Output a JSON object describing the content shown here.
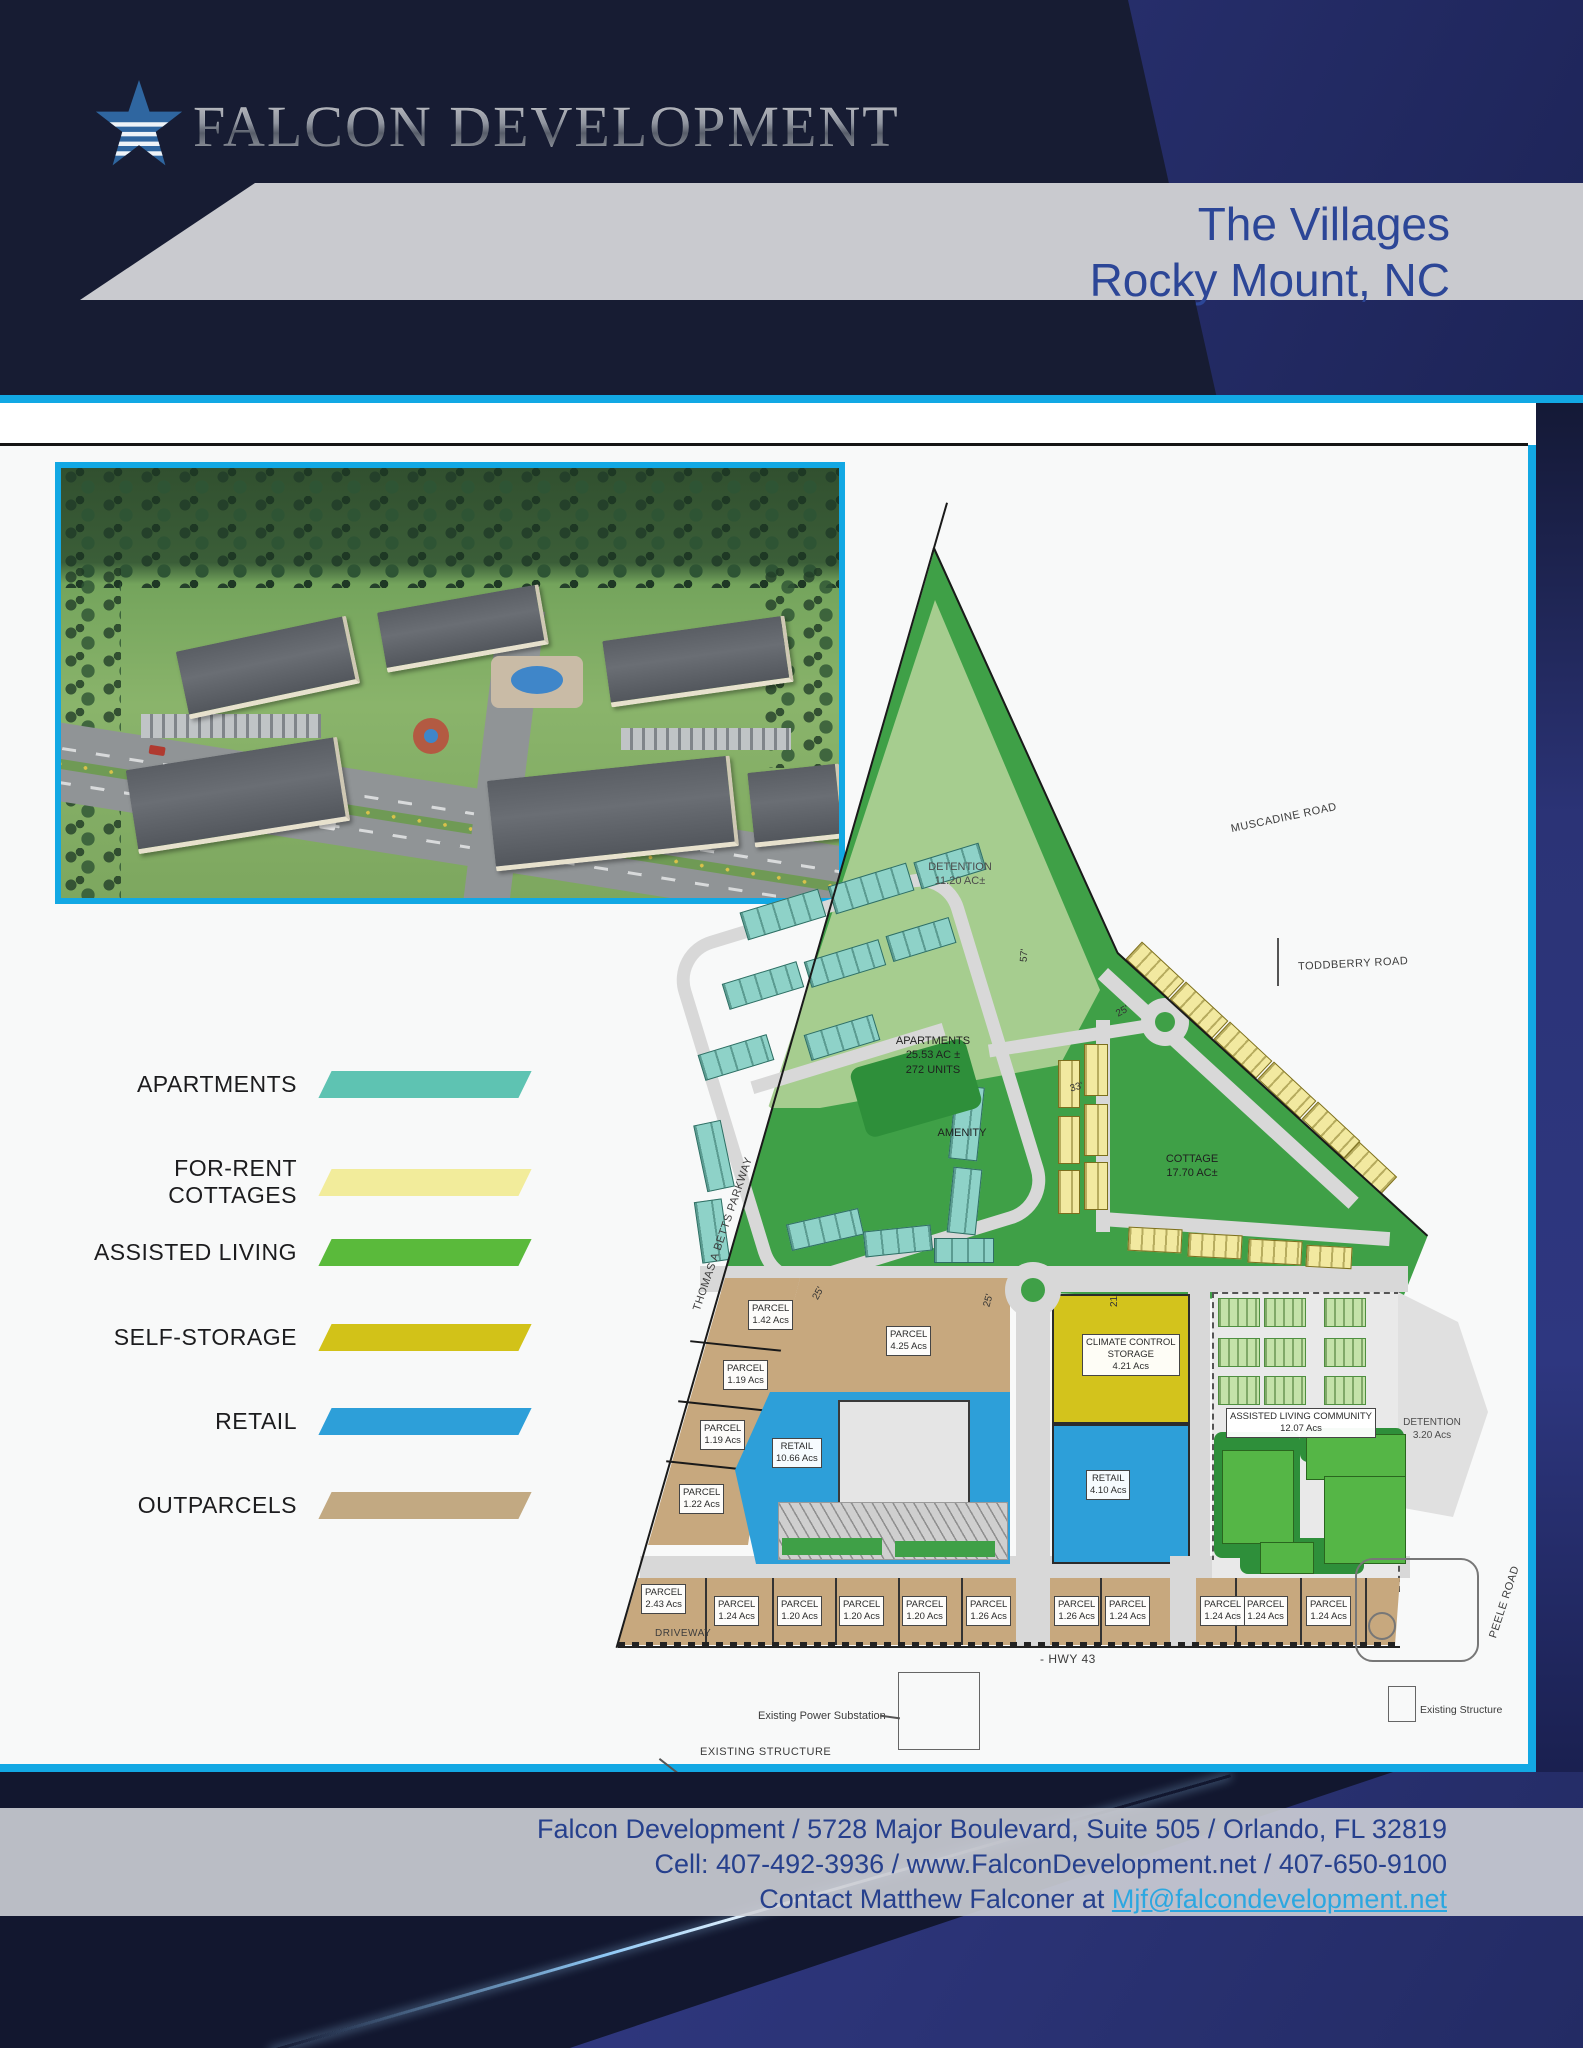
{
  "header": {
    "brand": "FALCON DEVELOPMENT",
    "title_line1": "The Villages",
    "title_line2": "Rocky Mount, NC"
  },
  "legend": {
    "items": [
      {
        "label": "APARTMENTS",
        "color": "#5ec3b2"
      },
      {
        "label": "FOR-RENT COTTAGES",
        "color": "#f2ec9b"
      },
      {
        "label": "ASSISTED LIVING",
        "color": "#5aba3b"
      },
      {
        "label": "SELF-STORAGE",
        "color": "#d2c218"
      },
      {
        "label": "RETAIL",
        "color": "#2d9fd9"
      },
      {
        "label": "OUTPARCELS",
        "color": "#c2a982"
      }
    ]
  },
  "plan": {
    "parcel_word": "PARCEL",
    "west_parcels": [
      "1.42 Acs",
      "1.19 Acs",
      "1.19 Acs",
      "1.22 Acs"
    ],
    "south_parcels": [
      "2.43 Acs",
      "1.24 Acs",
      "1.20 Acs",
      "1.20 Acs",
      "1.20 Acs",
      "1.26 Acs",
      "1.26 Acs",
      "1.24 Acs",
      "1.24 Acs",
      "1.24 Acs",
      "1.24 Acs"
    ],
    "areas": {
      "detention_top": [
        "DETENTION",
        "11.20 AC±"
      ],
      "apartments": [
        "APARTMENTS",
        "25.53 AC ±",
        "272 UNITS"
      ],
      "amenity": "AMENITY",
      "cottage": [
        "COTTAGE",
        "17.70 AC±"
      ],
      "parcel_center": [
        "PARCEL",
        "4.25 Acs"
      ],
      "retail_main": [
        "RETAIL",
        "10.66 Acs"
      ],
      "storage": [
        "CLIMATE CONTROL",
        "STORAGE",
        "4.21 Acs"
      ],
      "retail_east": [
        "RETAIL",
        "4.10 Acs"
      ],
      "assisted_living": [
        "ASSISTED LIVING COMMUNITY",
        "12.07 Acs"
      ],
      "detention_east": [
        "DETENTION",
        "3.20 Acs"
      ]
    },
    "roads": {
      "muscadine": "MUSCADINE ROAD",
      "toddberry": "TODDBERRY ROAD",
      "thomas_betts": "THOMAS A BETTS PARKWAY",
      "peele": "PEELE ROAD",
      "driveway": "DRIVEWAY",
      "hwy43": "- HWY 43"
    },
    "annotations": {
      "power_substation": "Existing Power Substation",
      "existing_structure_sw": "EXISTING STRUCTURE",
      "existing_structure_se": "Existing Structure"
    },
    "dimensions": {
      "a": "25'",
      "b": "25'",
      "c": "33'",
      "d": "57'",
      "e": "21'",
      "f": "25'"
    }
  },
  "colors": {
    "accent_cyan": "#12a8e4",
    "navy": "#171c33",
    "royal_blue": "#2e3780",
    "title_blue": "#2c4697",
    "plan_green": "#3fa047",
    "plan_light_green": "#a6cd8f",
    "storage_yellow": "#d3c31c",
    "retail_blue": "#2d9fd9",
    "outparcel_tan": "#c7a87e",
    "assisted_gray": "#e9e9e9",
    "road_gray": "#d8d8d8",
    "link_blue": "#2ba7e0"
  },
  "footer": {
    "line1": "Falcon Development / 5728 Major Boulevard, Suite 505 / Orlando, FL 32819",
    "line2": "Cell: 407-492-3936  / www.FalconDevelopment.net  /  407-650-9100",
    "line3_prefix": "Contact Matthew Falconer at ",
    "email": "Mjf@falcondevelopment.net"
  }
}
